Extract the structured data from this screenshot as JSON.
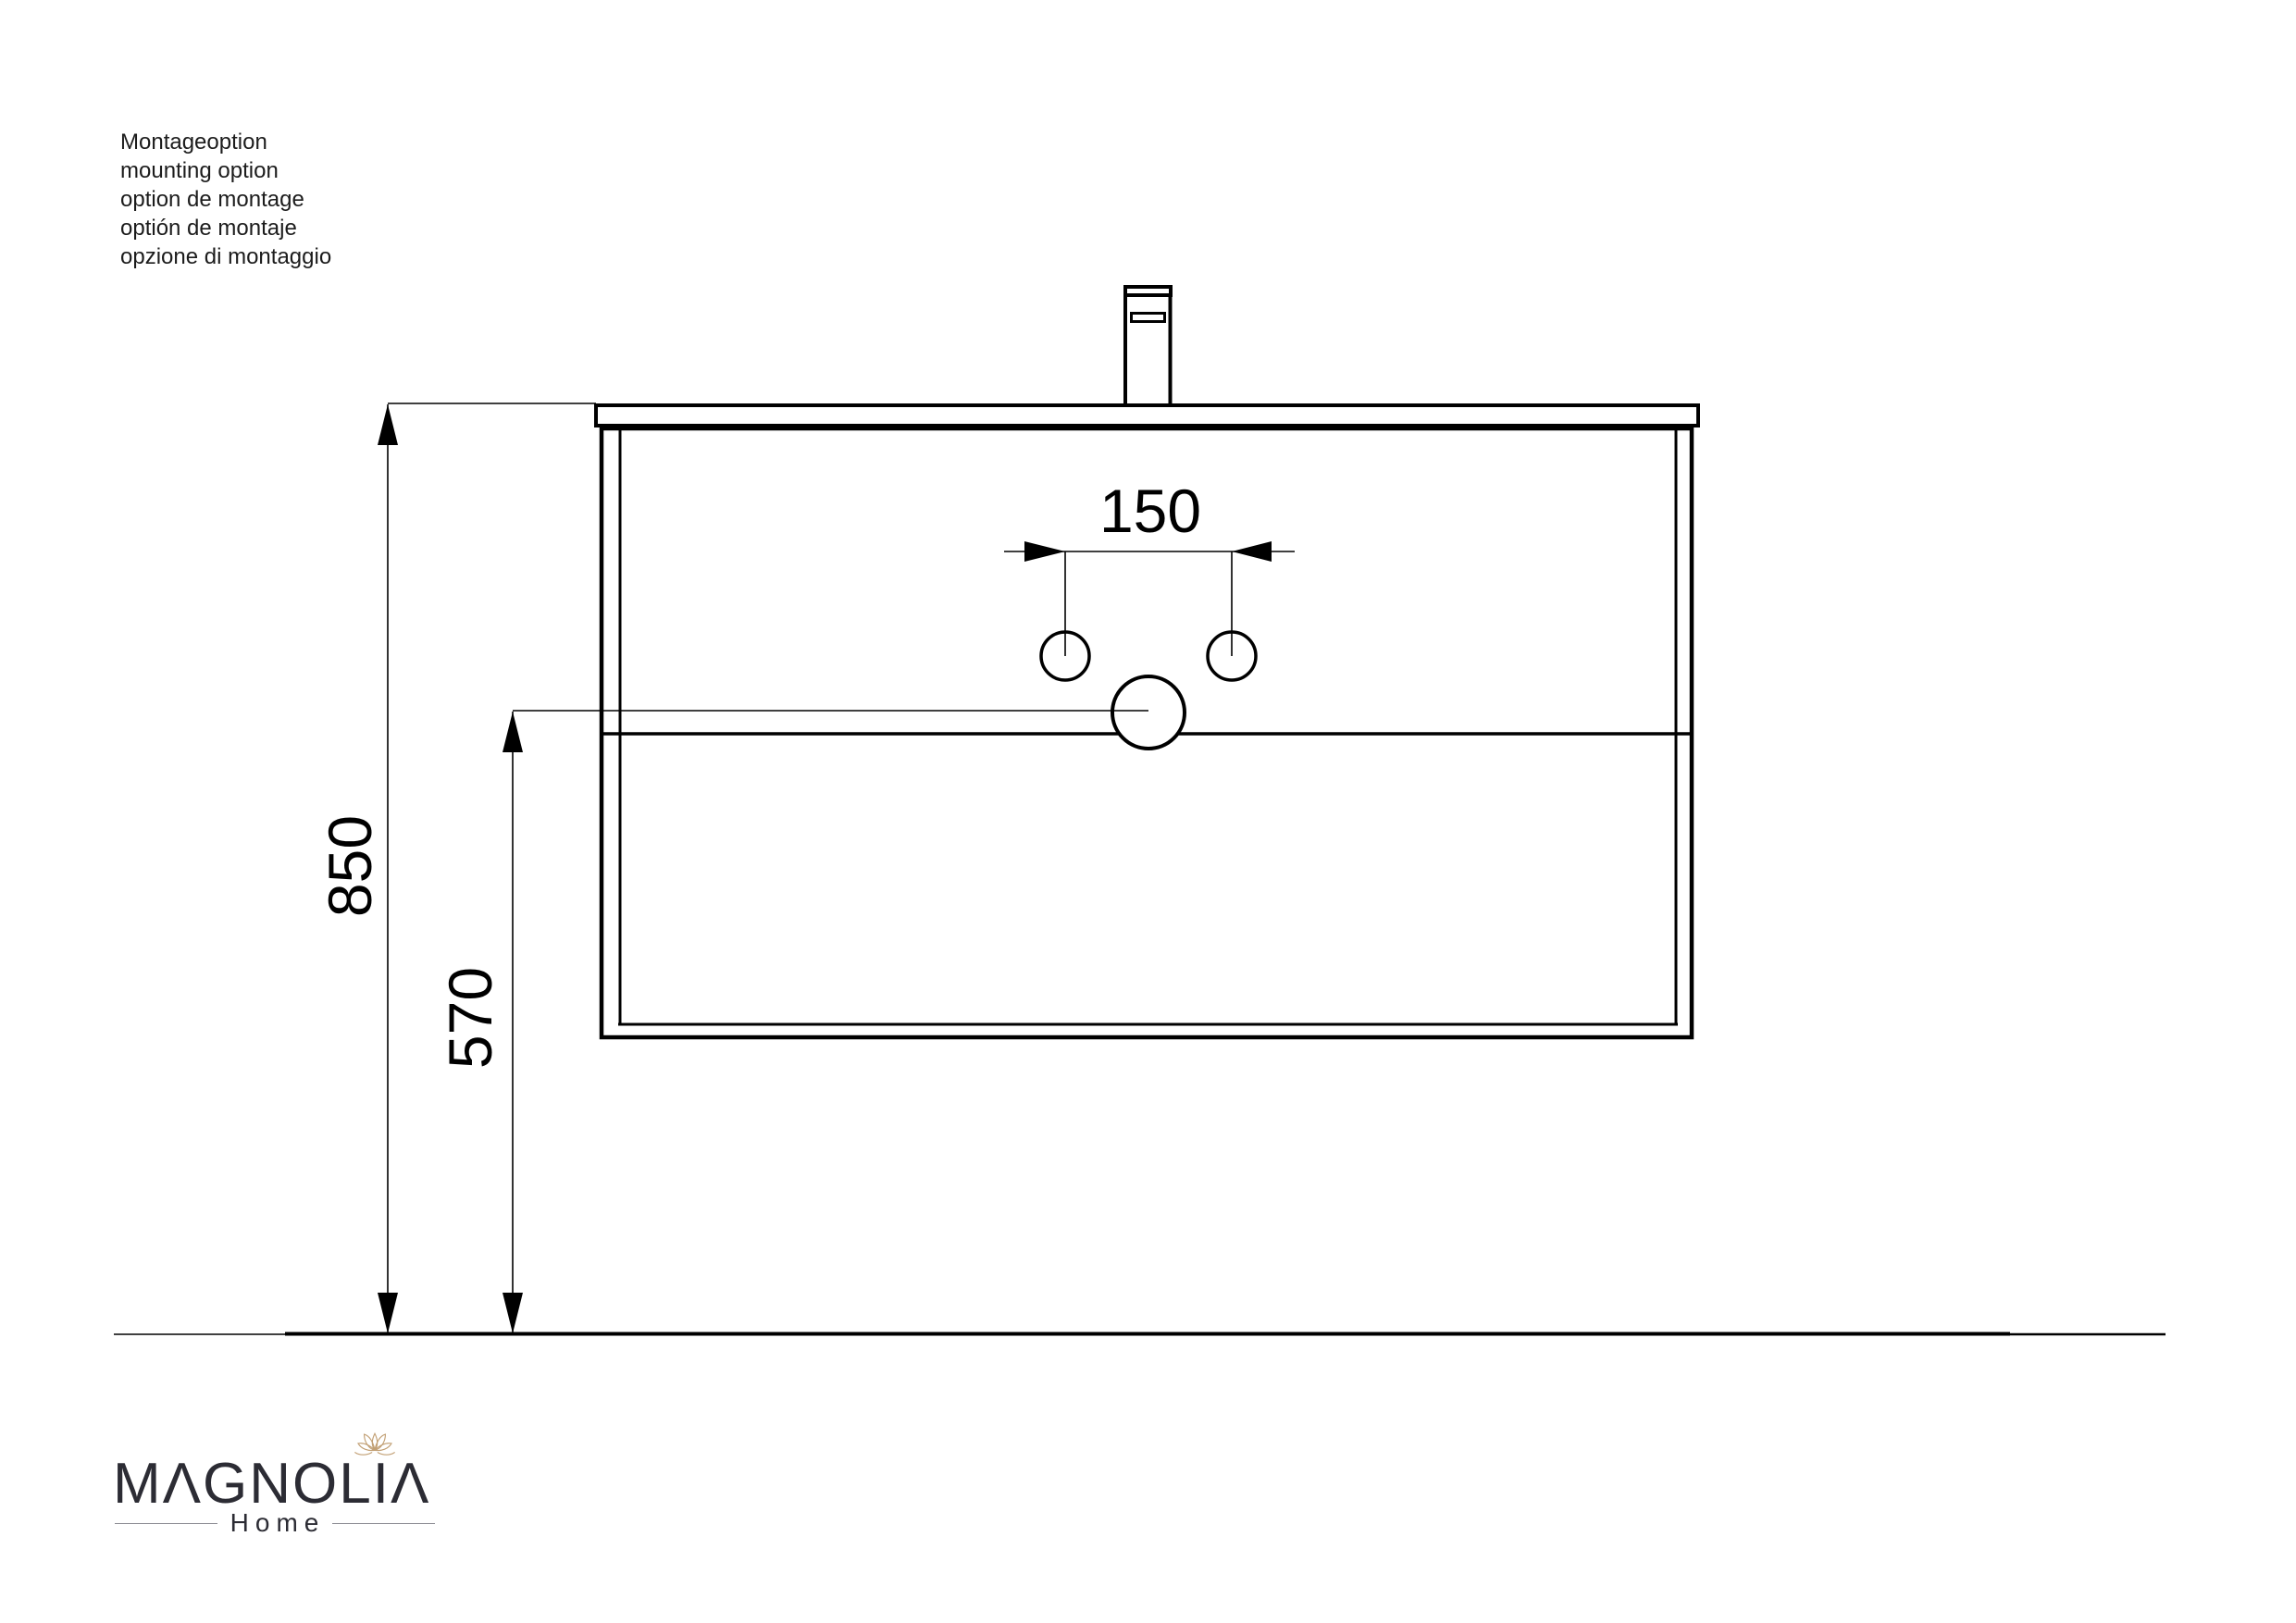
{
  "background_color": "#ffffff",
  "line_color": "#000000",
  "info_block": {
    "lines": [
      "Montageoption",
      "mounting option",
      "option de montage",
      "optión de montaje",
      "opzione di montaggio"
    ]
  },
  "dimensions": {
    "hole_spacing": {
      "label": "150"
    },
    "overall_height": {
      "label": "850"
    },
    "outlet_height": {
      "label": "570"
    }
  },
  "logo": {
    "name": "MAGNOLIA",
    "display": "MΛGNOLIΛ",
    "subtitle": "Home",
    "text_color": "#2c2c34",
    "flower_color": "#c2a075",
    "rule_color": "#8f8f96"
  }
}
